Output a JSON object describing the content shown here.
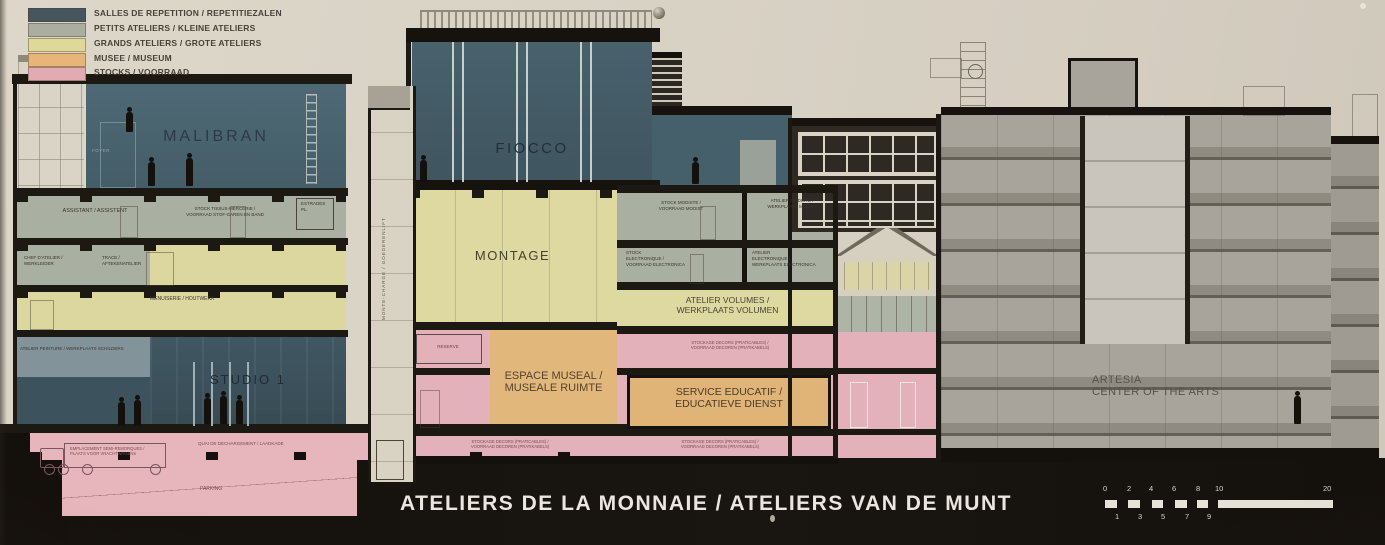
{
  "title": "ATELIERS DE LA MONNAIE / ATELIERS VAN DE MUNT",
  "legend": {
    "items": [
      {
        "label": "SALLES DE REPETITION / REPETITIEZALEN",
        "color": "#46565e"
      },
      {
        "label": "PETITS ATELIERS / KLEINE ATELIERS",
        "color": "#a9aea0"
      },
      {
        "label": "GRANDS ATELIERS / GROTE ATELIERS",
        "color": "#ded998"
      },
      {
        "label": "MUSEE / MUSEUM",
        "color": "#e6b577"
      },
      {
        "label": "STOCKS / VOORRAAD",
        "color": "#e3aab2"
      }
    ]
  },
  "halls": {
    "malibran": "MALIBRAN",
    "fiocco": "FIOCCO",
    "montage": "MONTAGE",
    "studio1": "STUDIO 1",
    "foyer": "FOYER",
    "artesia": {
      "l1": "ARTESIA",
      "l2": "CENTER OF THE ARTS"
    }
  },
  "rooms": {
    "assistant": "ASSISTANT / ASSISTENT",
    "stock_tissus": {
      "l1": "STOCK TISSUS-MERCERIE /",
      "l2": "VOORRAAD STOF-GAREN EN BAND"
    },
    "estrades": {
      "l1": "ESTRADES",
      "l2": "PL."
    },
    "chef_atelier": {
      "l1": "CHEF D'ATELIER /",
      "l2": "WERKLEIDER"
    },
    "trace": {
      "l1": "TRACE /",
      "l2": "AFTEKENATELIER"
    },
    "menuiserie": "MENUISERIE / HOUTWERK",
    "atelier_peinture": "ATELIER PEINTURE / WERKPLAATS SCHILDERS",
    "monte_charge": "MONTE-CHARGE / GOEDERENLIFT",
    "stock_modiste": {
      "l1": "STOCK MODISTE /",
      "l2": "VOORRAAD MODIST"
    },
    "atelier_modiste": {
      "l1": "ATELIER MODISTE /",
      "l2": "WERKPLAATS MODIST"
    },
    "stock_electronique": {
      "l1": "STOCK",
      "l2": "ELECTRONIQUE /",
      "l3": "VOORRAAD ELECTRONICA"
    },
    "atelier_electronique": {
      "l1": "ATELIER",
      "l2": "ELECTRONIQUE /",
      "l3": "WERKPLAATS ELECTRONICA"
    },
    "atelier_volumes": {
      "l1": "ATELIER VOLUMES /",
      "l2": "WERKPLAATS VOLUMEN"
    },
    "stockage_decors": {
      "l1": "STOCKAGE DECORS (PRATICABLES) /",
      "l2": "VOORRAAD DECOREN (PRATIKABELS)"
    },
    "reserve": "RESERVE",
    "espace_museal": {
      "l1": "ESPACE MUSEAL /",
      "l2": "MUSEALE RUIMTE"
    },
    "service_educatif": {
      "l1": "SERVICE EDUCATIF /",
      "l2": "EDUCATIEVE DIENST"
    },
    "emplacement": {
      "l1": "EMPLACEMENT SEMI-REMORQUES /",
      "l2": "PLAATS VOOR VRACHTWAGENS"
    },
    "quai": "QUAI DE DECHARGEMENT / LAADKADE",
    "parking": "PARKING"
  },
  "scalebar": {
    "top": [
      "0",
      "2",
      "4",
      "6",
      "8",
      "10",
      "20"
    ],
    "bottom": [
      "1",
      "3",
      "5",
      "7",
      "9"
    ]
  },
  "colors": {
    "paper": "#d8d2c5",
    "band_black": "#14100c",
    "teal_halls": "#46606a",
    "grey_green": "#a9afa1",
    "pale_yellow": "#ded9a1",
    "museum_orange": "#e2b77c",
    "stock_pink": "#e2b1b9",
    "concrete_grey": "#a9a49b",
    "title_white": "#ebe7e0"
  }
}
